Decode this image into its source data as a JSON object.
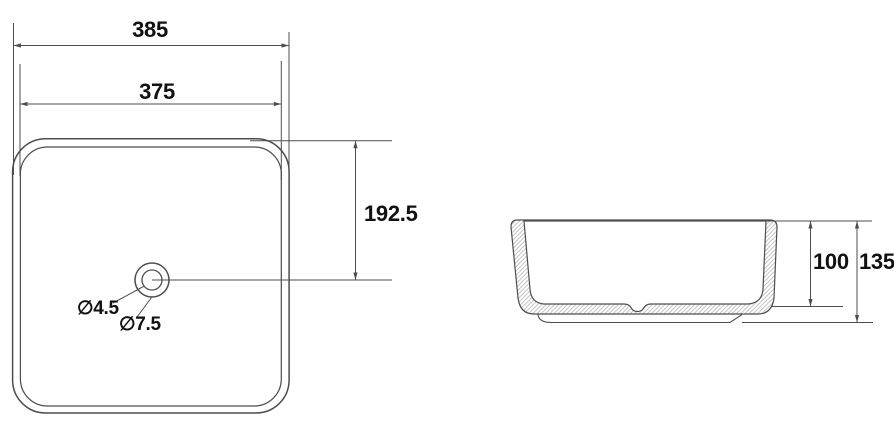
{
  "drawing": {
    "title": "Square countertop washbasin technical drawing",
    "top_view": {
      "dim_outer_width": "385",
      "dim_inner_width": "375",
      "dim_center_offset": "192.5",
      "dim_drain_small": "∅4.5",
      "dim_drain_large": "∅7.5"
    },
    "side_view": {
      "dim_inner_depth": "100",
      "dim_overall_height": "135"
    },
    "colors": {
      "line": "#4d4d4d",
      "hatch": "#b0b0b0",
      "text": "#111111",
      "background": "#ffffff"
    }
  }
}
